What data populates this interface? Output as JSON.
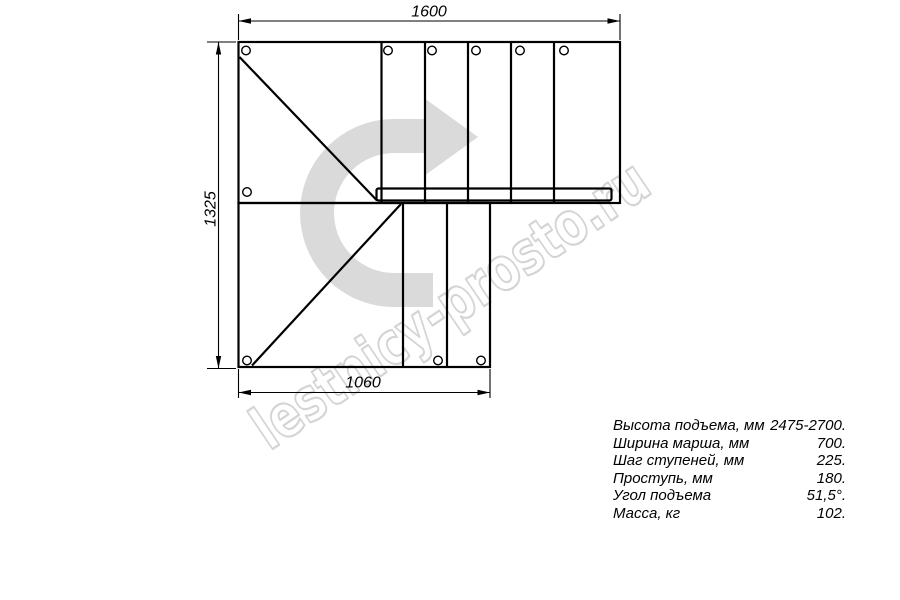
{
  "page": {
    "background": "#ffffff"
  },
  "drawing": {
    "watermark": "lestnicy-prosto.ru",
    "direction_arrow_icon": "curved-right-arrow",
    "dimensions": {
      "top": "1600",
      "left": "1325",
      "bottom": "1060"
    }
  },
  "spec": {
    "rows": [
      {
        "label": "Высота подъема, мм",
        "value": "2475-2700."
      },
      {
        "label": "Ширина марша, мм",
        "value": "700."
      },
      {
        "label": "Шаг ступеней, мм",
        "value": "225."
      },
      {
        "label": "Проступь, мм",
        "value": "180."
      },
      {
        "label": "Угол подъема",
        "value": "51,5°."
      },
      {
        "label": "Масса, кг",
        "value": "102."
      }
    ]
  },
  "colors": {
    "line": "#000000",
    "arrow": "#dadada",
    "watermark_outline": "#c6c6c6"
  }
}
